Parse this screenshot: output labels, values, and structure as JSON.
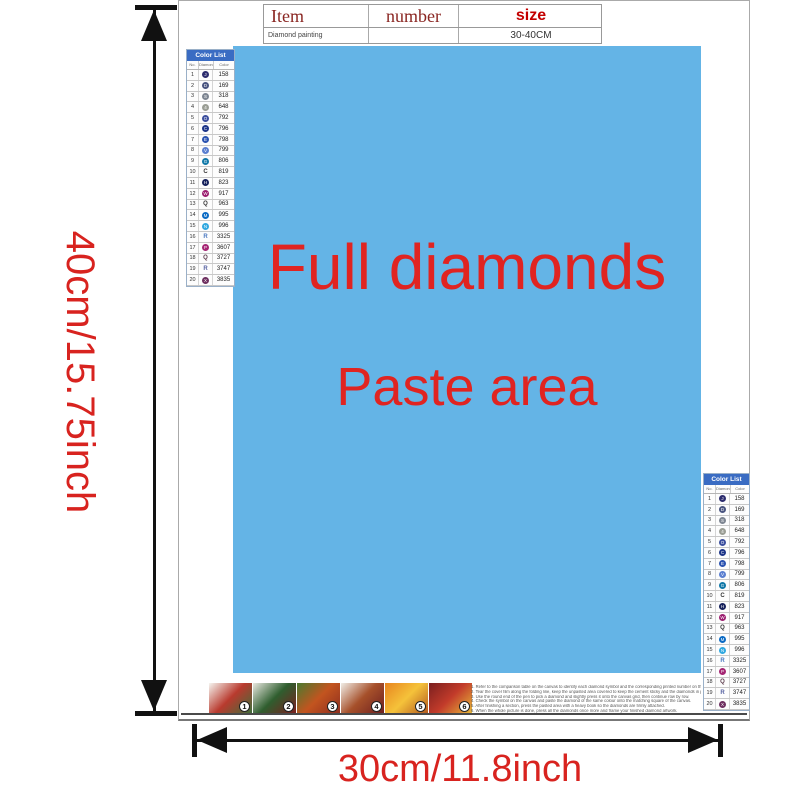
{
  "dimensions": {
    "vertical_label": "40cm/15.75inch",
    "horizontal_label": "30cm/11.8inch",
    "label_color": "#d8231f"
  },
  "item_table": {
    "headers": {
      "item": "Item",
      "number": "number",
      "size": "size"
    },
    "row": {
      "item": "Diamond painting",
      "number": "",
      "size": "30-40CM"
    }
  },
  "paste_area": {
    "line1": "Full diamonds",
    "line2": "Paste area",
    "bg_color": "#64b4e6",
    "text_color": "#e02421"
  },
  "color_list": {
    "title": "Color List",
    "columns": [
      "No.",
      "Diamond",
      "Color"
    ],
    "rows": [
      {
        "no": "1",
        "sym": "J",
        "type": "circle",
        "color": "#2c2c6e",
        "code": "158"
      },
      {
        "no": "2",
        "sym": "D",
        "type": "circle",
        "color": "#4a5580",
        "code": "169"
      },
      {
        "no": "3",
        "sym": "S",
        "type": "circle",
        "color": "#7d8591",
        "code": "318"
      },
      {
        "no": "4",
        "sym": "4",
        "type": "circle",
        "color": "#9a9d94",
        "code": "648"
      },
      {
        "no": "5",
        "sym": "O",
        "type": "circle",
        "color": "#3c4f9e",
        "code": "792"
      },
      {
        "no": "6",
        "sym": "C",
        "type": "circle",
        "color": "#1d3588",
        "code": "796"
      },
      {
        "no": "7",
        "sym": "E",
        "type": "circle",
        "color": "#2a52b0",
        "code": "798"
      },
      {
        "no": "8",
        "sym": "V",
        "type": "circle",
        "color": "#5b7fd0",
        "code": "799"
      },
      {
        "no": "9",
        "sym": "G",
        "type": "circle",
        "color": "#1178a8",
        "code": "806"
      },
      {
        "no": "10",
        "sym": "C",
        "type": "letter",
        "color": "#333333",
        "code": "819"
      },
      {
        "no": "11",
        "sym": "H",
        "type": "circle",
        "color": "#16215c",
        "code": "823"
      },
      {
        "no": "12",
        "sym": "W",
        "type": "circle",
        "color": "#9c1f70",
        "code": "917"
      },
      {
        "no": "13",
        "sym": "Q",
        "type": "letter",
        "color": "#333333",
        "code": "963"
      },
      {
        "no": "14",
        "sym": "M",
        "type": "circle",
        "color": "#0a6ac4",
        "code": "995"
      },
      {
        "no": "15",
        "sym": "N",
        "type": "circle",
        "color": "#30a8e0",
        "code": "996"
      },
      {
        "no": "16",
        "sym": "R",
        "type": "letter",
        "color": "#4a78c0",
        "code": "3325"
      },
      {
        "no": "17",
        "sym": "P",
        "type": "circle",
        "color": "#a52573",
        "code": "3607"
      },
      {
        "no": "18",
        "sym": "Q",
        "type": "letter",
        "color": "#5a3a4a",
        "code": "3727"
      },
      {
        "no": "19",
        "sym": "R",
        "type": "letter",
        "color": "#5560a0",
        "code": "3747"
      },
      {
        "no": "20",
        "sym": "X",
        "type": "circle",
        "color": "#6e3060",
        "code": "3835"
      }
    ]
  },
  "steps": {
    "items": [
      {
        "num": "1",
        "colors": [
          "#f5f5f0",
          "#b93a2e",
          "#3e6e3a"
        ]
      },
      {
        "num": "2",
        "colors": [
          "#e8e8e0",
          "#2f5e2f",
          "#7a1f1f"
        ]
      },
      {
        "num": "3",
        "colors": [
          "#4a7a2f",
          "#c2541f",
          "#8f2f1f"
        ]
      },
      {
        "num": "4",
        "colors": [
          "#f0ede6",
          "#a6502a",
          "#6e1f1f"
        ]
      },
      {
        "num": "5",
        "colors": [
          "#e8861f",
          "#f5c23a",
          "#b35a1f"
        ]
      },
      {
        "num": "6",
        "colors": [
          "#7a1f1f",
          "#c23b2a",
          "#e8b83a"
        ]
      }
    ]
  },
  "instructions": {
    "lines": [
      "1. Refer to the comparison table on the canvas to identify each diamond symbol and the corresponding printed number on the canvas.",
      "2. Tear the cover film along the folding line, keep the unpasted area covered to keep the cement sticky and the diamonds in place.",
      "3. Use the round end of the pen to pick a diamond and slightly press it onto the canvas grid, then continue row by row.",
      "4. Check the symbol on the canvas and paste the diamond of the same colour onto the matching square of the canvas.",
      "5. After finishing a section, press the pasted area with a heavy book so the diamonds are firmly attached.",
      "6. When the whole picture is done, press all the diamonds once more and frame your finished diamond artwork."
    ]
  }
}
